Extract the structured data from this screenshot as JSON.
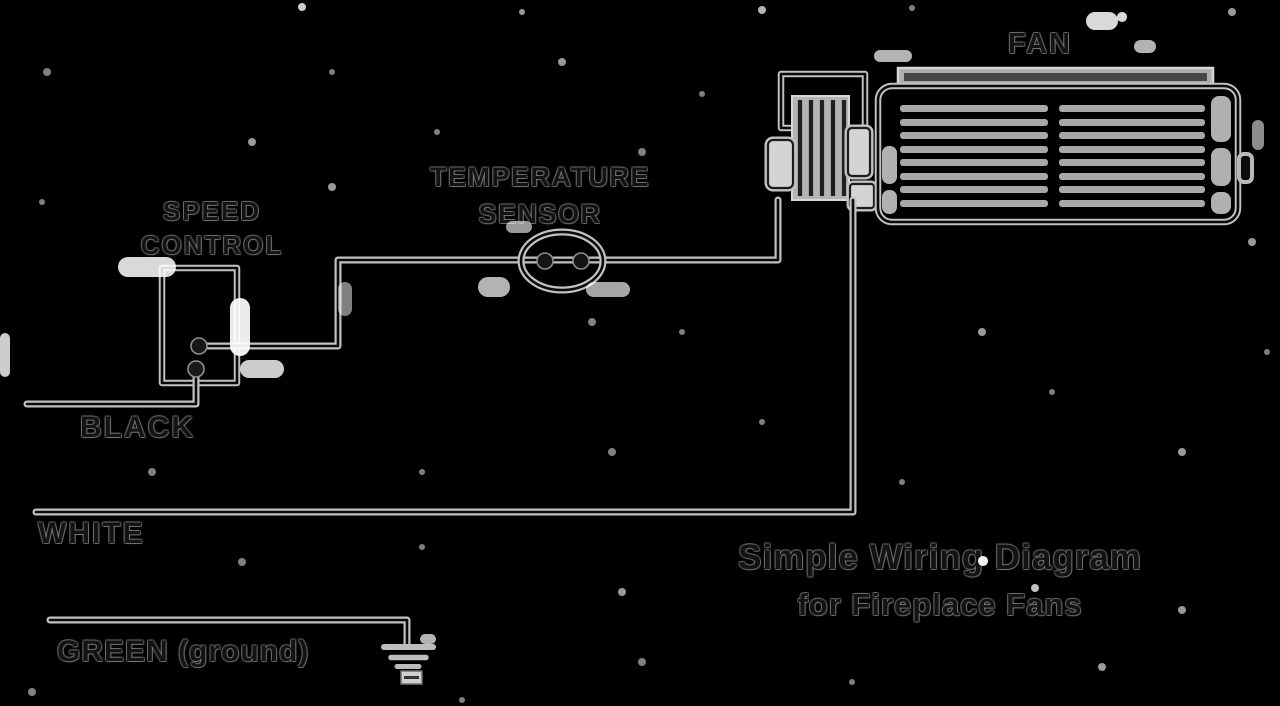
{
  "diagram": {
    "title_line1": "Simple Wiring Diagram",
    "title_line2": "for Fireplace Fans",
    "labels": {
      "fan": "FAN",
      "temperature_sensor_line1": "TEMPERATURE",
      "temperature_sensor_line2": "SENSOR",
      "speed_control_line1": "SPEED",
      "speed_control_line2": "CONTROL",
      "wire_black": "BLACK",
      "wire_white": "WHITE",
      "wire_green": "GREEN (ground)"
    },
    "components": {
      "fan": "fan blower assembly",
      "fan_motor": "fan motor with winding hatch",
      "temperature_sensor": "inline temperature sensor with two terminals",
      "speed_control": "speed control box with two terminals",
      "ground_symbol": "earth ground symbol"
    },
    "colors": {
      "background": "#000000",
      "line_halo": "#c2c2c2",
      "ink_core": "#0a0a0a",
      "slat_gray": "#a8a8a8",
      "artifact_white": "#ffffff"
    }
  }
}
